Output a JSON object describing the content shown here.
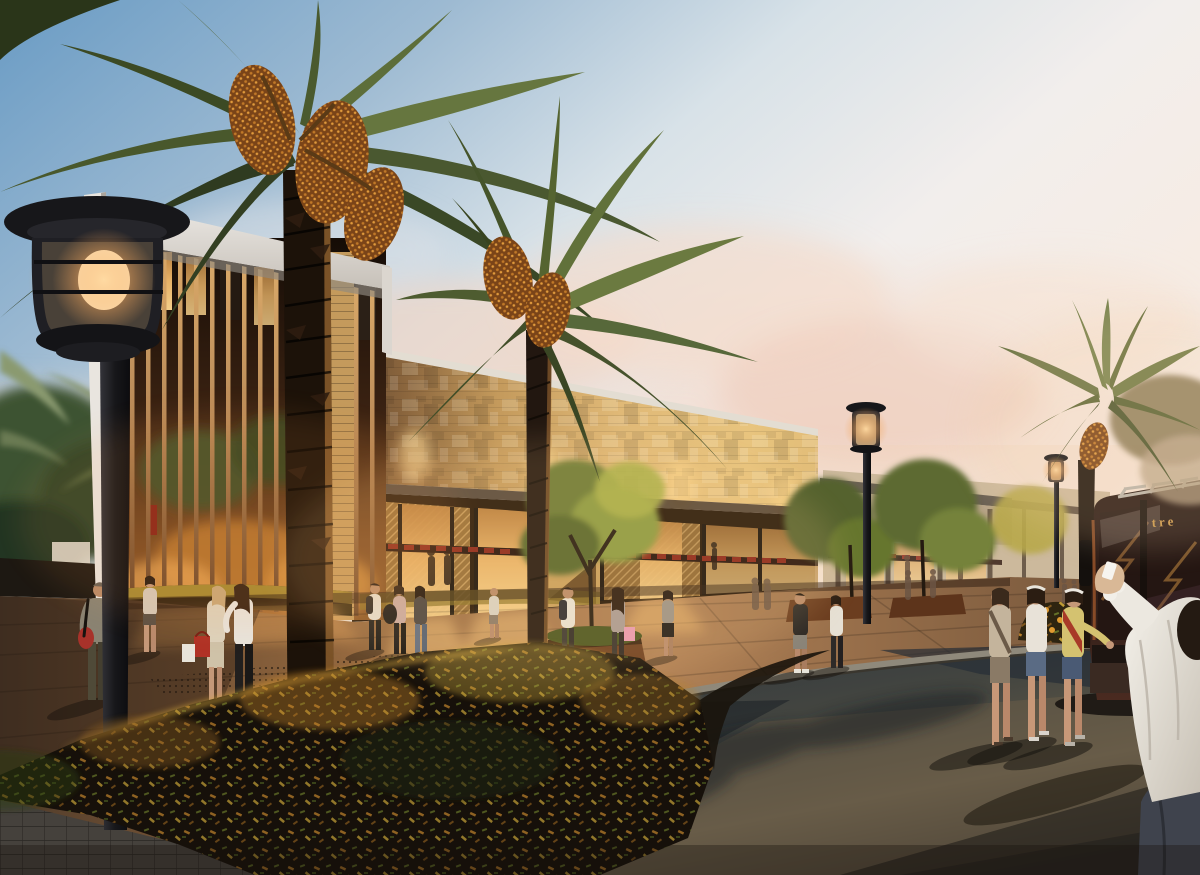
{
  "meta": {
    "title": "Architectural rendering: shopping mall plaza at dusk with date palms, pedestrians and shuttle bus"
  },
  "scene": {
    "setting": "outdoor retail plaza at sunset",
    "landmarks": [
      "timber-slat tower pavilion",
      "stone-clad mall facade with relief block pattern",
      "glowing storefronts with red awnings",
      "date palms with fruit clusters",
      "black street lanterns",
      "curved asphalt roadway",
      "flowering foreground shrubs",
      "shuttle bus at right edge"
    ],
    "lighting": "warm dusk glow, interior retail lighting spilling onto plaza"
  },
  "bus": {
    "signage_text": "tre"
  },
  "palette": {
    "sky_top": "#699bc4",
    "sky_mid": "#d8e2e8",
    "sky_horizon": "#f6ece4",
    "cloud_pink": "#f2d8c9",
    "stone_lit": "#e0b977",
    "stone_shadow": "#6b4e33",
    "fascia_white": "#efece8",
    "slat_wood": "#b98a58",
    "glass_glow": "#e8b368",
    "awning_red": "#8a2418",
    "pavement_warm": "#b08055",
    "pavement_shadow": "#4f3b2a",
    "road_dark": "#2c333d",
    "road_warm": "#645a48",
    "curb_light": "#8f897b",
    "bush_dark": "#16100a",
    "bush_gold": "#c98a2e",
    "foliage_green": "#7a8f3e",
    "palm_green": "#49582c",
    "trunk_dark": "#221710",
    "lamp_black": "#17171a",
    "lamp_glow": "#ffd9a0",
    "bus_body": "#33201a",
    "bus_gold": "#c9984a",
    "hedge_yellow": "#b89a38"
  }
}
